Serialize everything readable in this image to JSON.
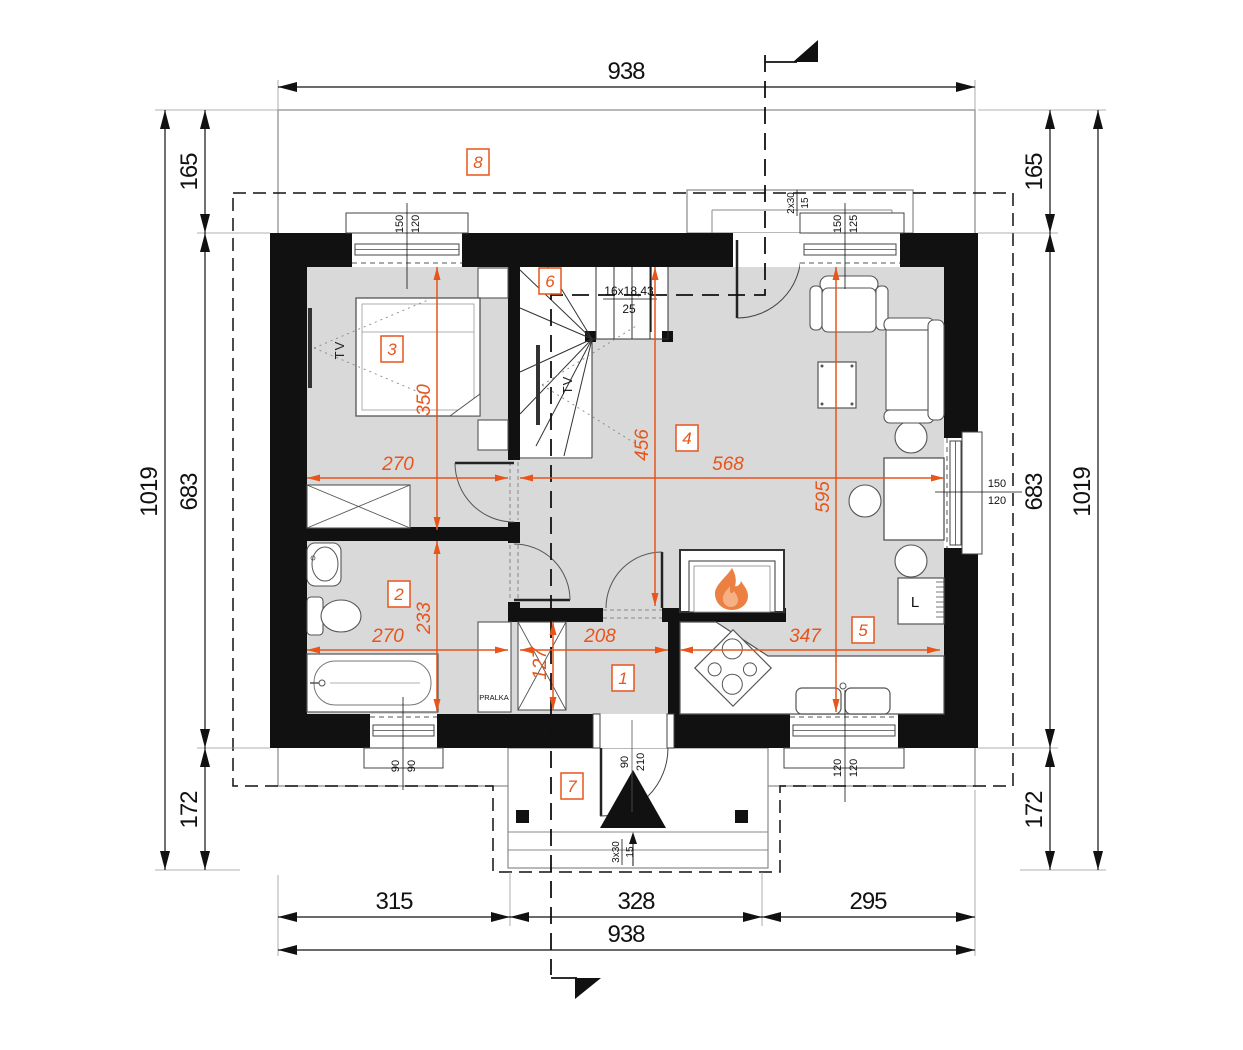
{
  "accent": "#e8541a",
  "outer_dims": {
    "top_total": "938",
    "bottom_total": "938",
    "bottom_segments": [
      "315",
      "328",
      "295"
    ],
    "left_total": "1019",
    "left_chain": [
      "165",
      "683",
      "172"
    ],
    "right_total": "1019",
    "right_chain": [
      "165",
      "683",
      "172"
    ]
  },
  "interior_dims": {
    "bedroom_width": "270",
    "bedroom_depth": "350",
    "bathroom_width": "270",
    "bathroom_depth": "233",
    "hall_width": "208",
    "hall_depth": "127",
    "kitchen_width": "347",
    "living_width": "568",
    "living_depth": "456",
    "living_depth2": "595"
  },
  "rooms": {
    "r1": "1",
    "r2": "2",
    "r3": "3",
    "r4": "4",
    "r5": "5",
    "r6": "6",
    "r7": "7",
    "r8": "8"
  },
  "stairs": {
    "spec": "16x18,43",
    "width": "25"
  },
  "openings": {
    "window_top_left": {
      "w": "150",
      "h": "120"
    },
    "window_top_right": {
      "w": "150",
      "h": "125"
    },
    "window_right": {
      "w": "150",
      "h": "120"
    },
    "window_bottom_left": {
      "w": "90",
      "h": "90"
    },
    "window_bottom_right": {
      "w": "120",
      "h": "120"
    },
    "entry_door": {
      "w": "90",
      "h": "210"
    }
  },
  "steps": {
    "terrace": {
      "count": "2x30",
      "rise": "15"
    },
    "porch": {
      "count": "3x30",
      "rise": "15"
    }
  },
  "labels": {
    "tv_bedroom": "TV",
    "tv_living": "TV",
    "washing_machine": "PRALKA",
    "fridge": "L"
  }
}
